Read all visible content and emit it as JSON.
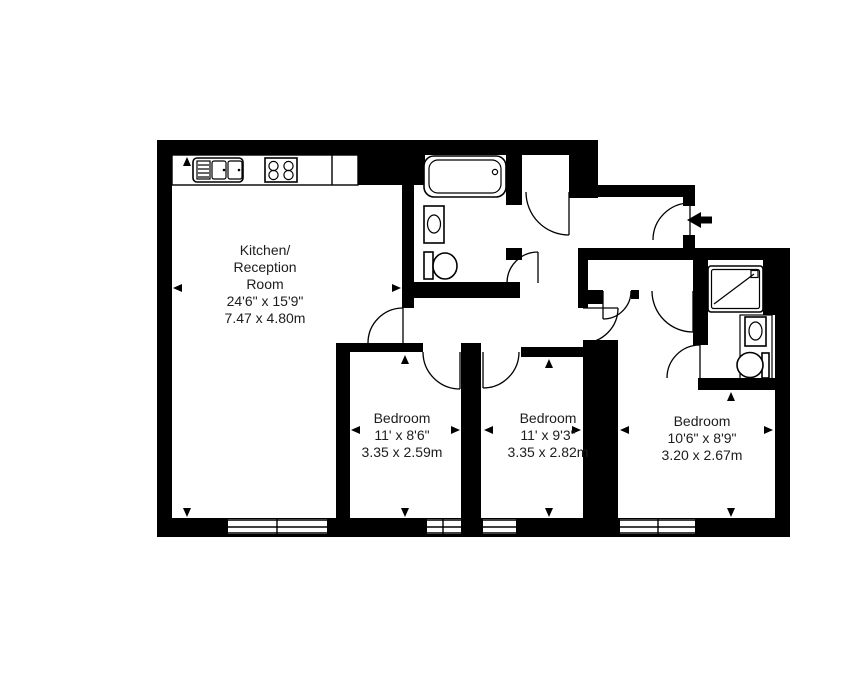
{
  "page": {
    "background_color": "#ffffff"
  },
  "plan": {
    "wall_color": "#000000",
    "line_color": "#000000",
    "text_color": "#1d1d1d",
    "rooms": {
      "kitchen_reception": {
        "name_lines": [
          "Kitchen/",
          "Reception",
          "Room"
        ],
        "dims_imperial": "24'6\" x 15'9\"",
        "dims_metric": "7.47 x 4.80m"
      },
      "bedroom_1": {
        "name": "Bedroom",
        "dims_imperial": "11' x 8'6\"",
        "dims_metric": "3.35 x 2.59m"
      },
      "bedroom_2": {
        "name": "Bedroom",
        "dims_imperial": "11' x 9'3\"",
        "dims_metric": "3.35 x 2.82m"
      },
      "bedroom_3": {
        "name": "Bedroom",
        "dims_imperial": "10'6\" x 8'9\"",
        "dims_metric": "3.20 x 2.67m"
      }
    },
    "fixtures": [
      "kitchen-sink",
      "hob",
      "bath",
      "basin",
      "toilet",
      "shower-tray",
      "wardrobe-doors"
    ],
    "entry": {
      "symbol": "entry-arrow"
    }
  }
}
